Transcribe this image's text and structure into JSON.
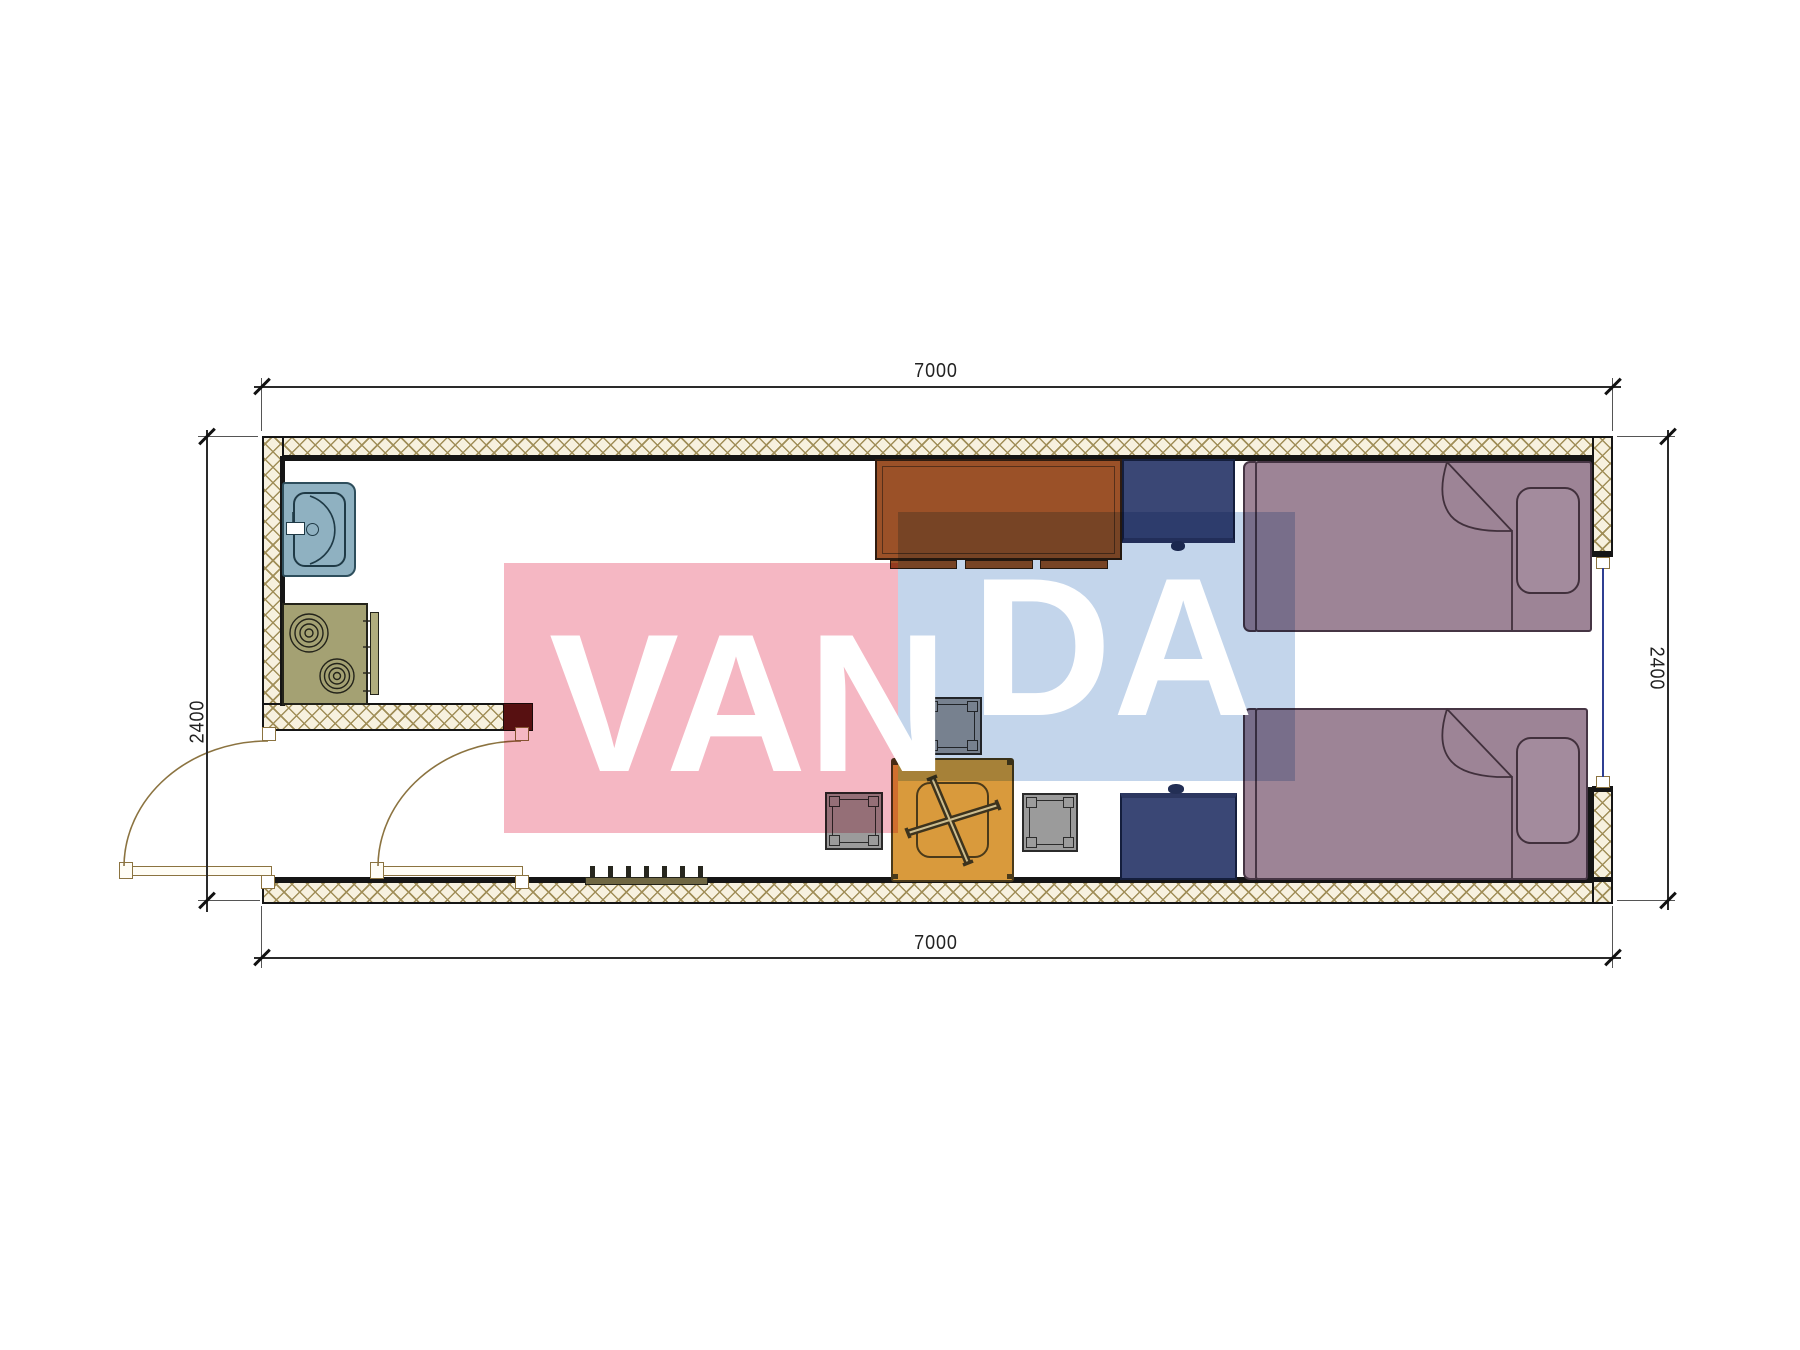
{
  "drawing": {
    "type": "floor-plan",
    "unit_hint": "mm",
    "dimensions": {
      "top": {
        "label": "7000"
      },
      "bottom": {
        "label": "7000"
      },
      "left": {
        "label": "2400"
      },
      "right": {
        "label": "2400"
      }
    },
    "watermark": {
      "part1": "VAN",
      "part2": "DA",
      "pink_block_color": "#f5b7c3",
      "blue_block_color": "#c3d5eb",
      "text_color": "#ffffff"
    },
    "furniture_icons": [
      {
        "name": "sink-icon",
        "color": "#8fb1c1"
      },
      {
        "name": "stove-icon",
        "color": "#a4a173"
      },
      {
        "name": "desk-icon",
        "color": "#9b5128"
      },
      {
        "name": "wardrobe-icon",
        "color": "#3a4775"
      },
      {
        "name": "nightstand-icon",
        "color": "#3a4775"
      },
      {
        "name": "bed-icon-top",
        "color": "#9d8496"
      },
      {
        "name": "bed-icon-bottom",
        "color": "#9d8496"
      },
      {
        "name": "table-icon",
        "color": "#d99a3c"
      },
      {
        "name": "stool-icon",
        "color": "#9b9b9b"
      },
      {
        "name": "heater-icon",
        "color": "#6f6742"
      },
      {
        "name": "door-icon",
        "color": "#8b7340"
      },
      {
        "name": "window-icon",
        "color": "#2f3f92"
      }
    ],
    "wall_style": {
      "hatch_line": "#a08e58",
      "hatch_bg": "#f7f1df",
      "outline": "#151515"
    }
  }
}
